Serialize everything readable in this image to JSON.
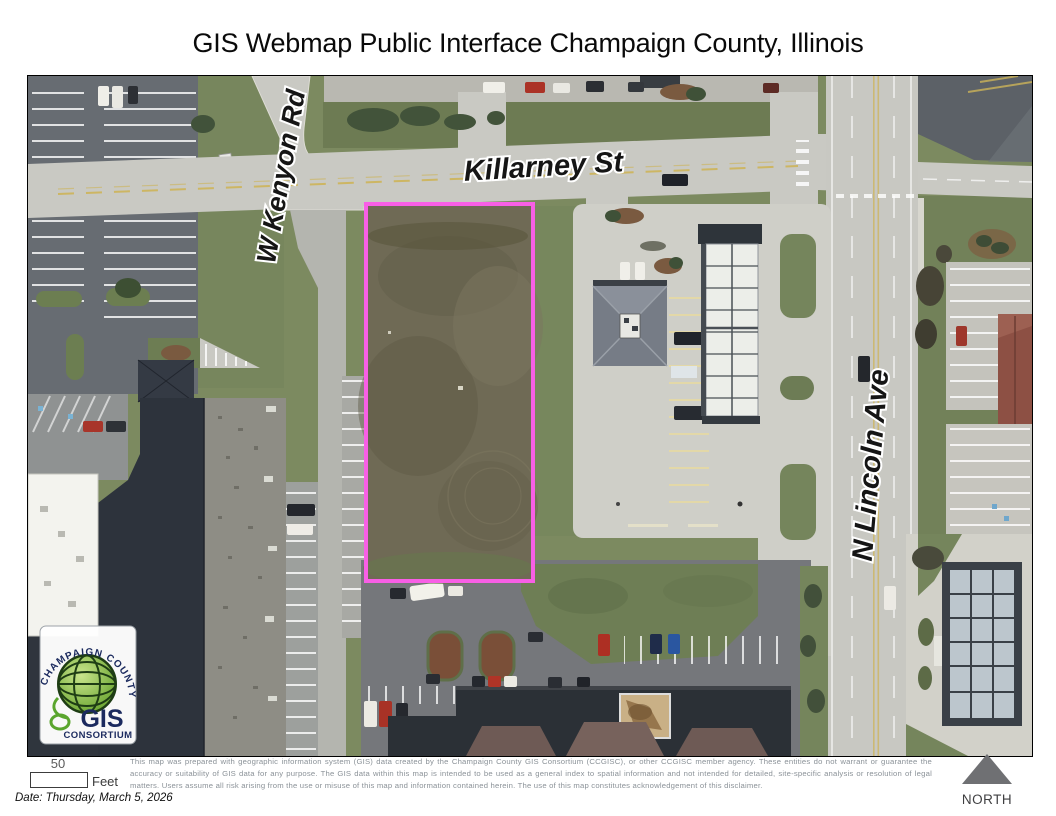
{
  "title": "GIS Webmap Public Interface Champaign County, Illinois",
  "map": {
    "parcel_outline_color": "#f85fe6",
    "labels": {
      "road_west": "W Kenyon Rd",
      "road_north": "Killarney St",
      "road_east": "N Lincoln Ave"
    },
    "logo": {
      "arc_text": "CHAMPAIGN COUNTY",
      "acronym": "GIS",
      "org": "CONSORTIUM"
    }
  },
  "footer": {
    "scale": {
      "value": "50",
      "unit": "Feet"
    },
    "date": "Date: Thursday, March 5, 2026",
    "north_label": "NORTH",
    "disclaimer": "This map was prepared with geographic information system (GIS) data created by the Champaign County GIS Consortium (CCGISC), or other CCGISC member agency. These entities do not warrant or guarantee the accuracy or suitability of GIS data for any purpose. The GIS data within this map is intended to be used as a general index to spatial information and not intended for detailed, site-specific analysis or resolution of legal matters. Users assume all risk arising from the use or misuse of this map and information contained herein. The use of this map constitutes acknowledgement of this disclaimer."
  }
}
